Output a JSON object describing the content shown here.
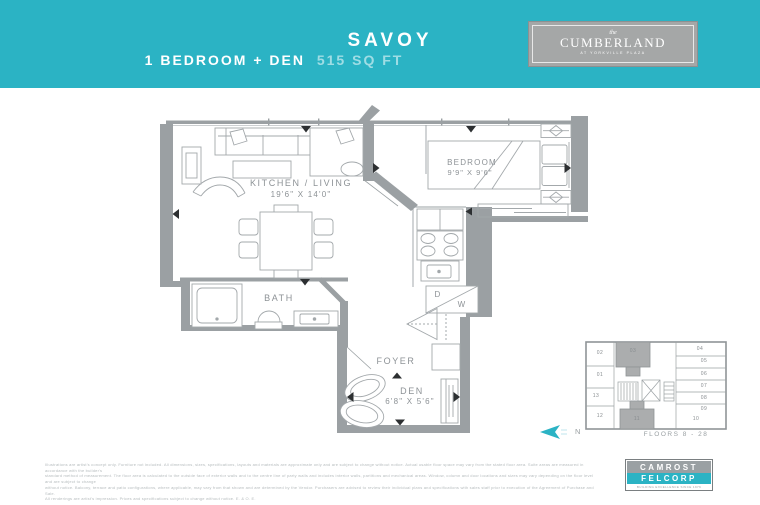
{
  "colors": {
    "accent": "#2bb3c4",
    "wall_gray": "#9ba0a3",
    "label_gray": "#8d9296"
  },
  "header": {
    "title": "SAVOY",
    "subtitle": "1 BEDROOM + DEN",
    "area": "515 SQ FT",
    "brand": {
      "pre": "the",
      "name": "CUMBERLAND",
      "tagline": "AT YORKVILLE PLAZA"
    }
  },
  "plan": {
    "kitchen_living_label": "KITCHEN / LIVING",
    "kitchen_living_dims": "19'6\" X 14'0\"",
    "bedroom_label": "BEDROOM",
    "bedroom_dims": "9'9\" X 9'6\"",
    "bath_label": "BATH",
    "foyer_label": "FOYER",
    "den_label": "DEN",
    "den_dims": "6'8\" X 5'6\"",
    "dryer_label": "D",
    "washer_label": "W"
  },
  "keyplan": {
    "units": [
      {
        "label": "01"
      },
      {
        "label": "02"
      },
      {
        "label": "03"
      },
      {
        "label": "04"
      },
      {
        "label": "05"
      },
      {
        "label": "06"
      },
      {
        "label": "07"
      },
      {
        "label": "08"
      },
      {
        "label": "09"
      },
      {
        "label": "10"
      },
      {
        "label": "11"
      },
      {
        "label": "12"
      },
      {
        "label": "13"
      }
    ],
    "highlighted": [
      "03",
      "11"
    ],
    "floors_label": "FLOORS 8 - 28"
  },
  "compass": {
    "label": "N"
  },
  "footer": {
    "disclaimer_lines": [
      "Illustrations are artist's concept only. Furniture not included. All dimensions, sizes, specifications, layouts and materials are approximate only and are subject to change without notice. Actual usable floor space may vary from the stated floor area. Suite areas are measured in accordance with the builder's",
      "standard method of measurement. The floor area is calculated to the outside face of exterior walls and to the centre line of party walls and includes interior walls, partitions and mechanical areas. Window, column and door locations and sizes may vary depending on the floor level and are subject to change",
      "without notice. Balcony, terrace and patio configurations, where applicable, may vary from that shown and are determined by the Vendor. Purchasers are advised to review their individual plans and specifications with sales staff prior to execution of the Agreement of Purchase and Sale.",
      "All renderings are artist's impression. Prices and specifications subject to change without notice. E. & O. E."
    ],
    "developer": {
      "line1": "CAMROST",
      "line2": "FELCORP",
      "tagline": "BUILDING EXCELLENCE SINCE 1976"
    }
  }
}
